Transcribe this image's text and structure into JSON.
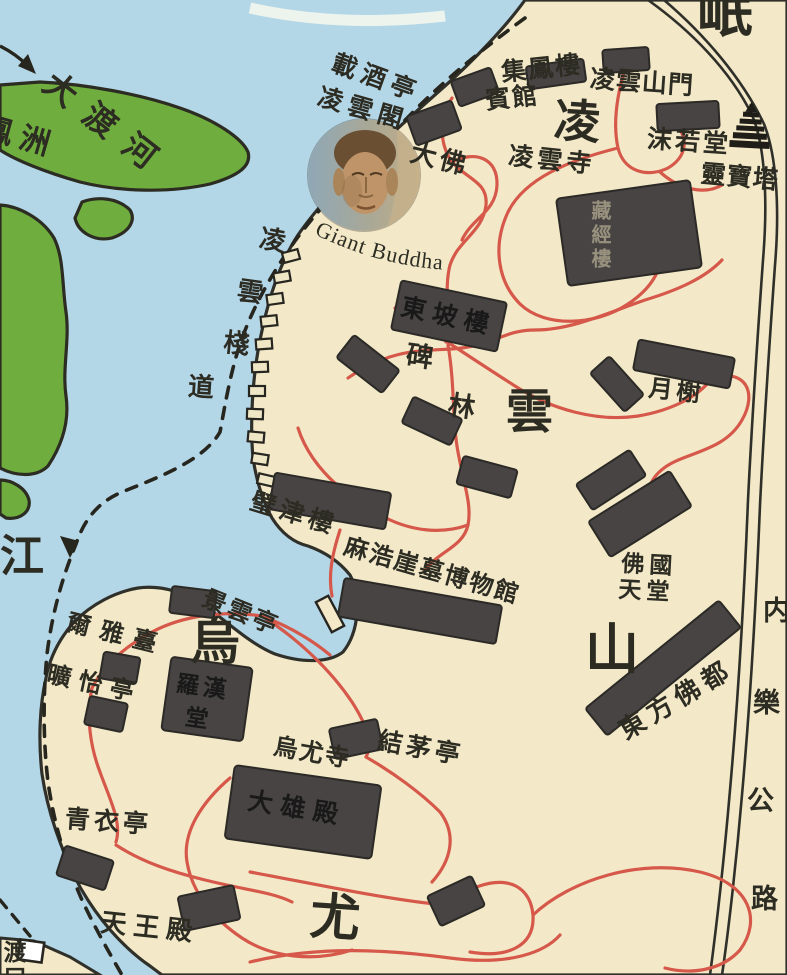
{
  "colors": {
    "water": "#b4d7e8",
    "land": "#f3e9c8",
    "island_green": "#6fae3e",
    "building_gray": "#474443",
    "path_red": "#d6584a",
    "ink": "#30302a"
  },
  "water": {
    "dadu_river": "大渡河",
    "fengzhou_island": "鳳洲",
    "min_river_chars": [
      "岷",
      "江"
    ],
    "ferry_crossing": "渡口"
  },
  "mountains": {
    "lingyun_chars": [
      "凌",
      "雲",
      "山"
    ],
    "wuyou_chars": [
      "烏",
      "尤"
    ]
  },
  "lingyun": {
    "zaijiu_pavilion": "載酒亭",
    "lingyun_pavilion": "凌雲閣",
    "jifeng_hotel_line1": "集鳳樓",
    "jifeng_hotel_line2": "賓館",
    "mountain_gate": "凌雲山門",
    "moruo_hall": "沫若堂",
    "lingbao_pagoda": "靈寶塔",
    "giant_buddha_cn": "大佛",
    "giant_buddha_en": "Giant Buddha",
    "lingyun_temple": "凌雲寺",
    "sutra_library": "藏經樓",
    "plank_road_chars": [
      "凌",
      "雲",
      "棧",
      "道"
    ],
    "dongpo_tower": "東坡樓",
    "stele_forest_chars": [
      "碑",
      "林"
    ],
    "moon_pavilion": "月榭",
    "bijin_tower": "璧津樓",
    "mahao_tomb_museum": "麻浩崖墓博物館",
    "buddhist_paradise_line1": "佛國",
    "buddhist_paradise_line2": "天堂",
    "oriental_buddha_capital": "東方佛都"
  },
  "wuyou": {
    "jingyun_pavilion": "景雲亭",
    "erya_terrace": "爾雅臺",
    "kuangyi_pavilion": "曠怡亭",
    "luohan_hall_line1": "羅漢",
    "luohan_hall_line2": "堂",
    "jiemao_pavilion": "結茅亭",
    "wuyou_temple": "烏尤寺",
    "daxiong_hall": "大雄殿",
    "qingyi_pavilion": "青衣亭",
    "tianwang_hall": "天王殿"
  },
  "roads": {
    "neile_highway_chars": [
      "内",
      "樂",
      "公",
      "路"
    ]
  }
}
